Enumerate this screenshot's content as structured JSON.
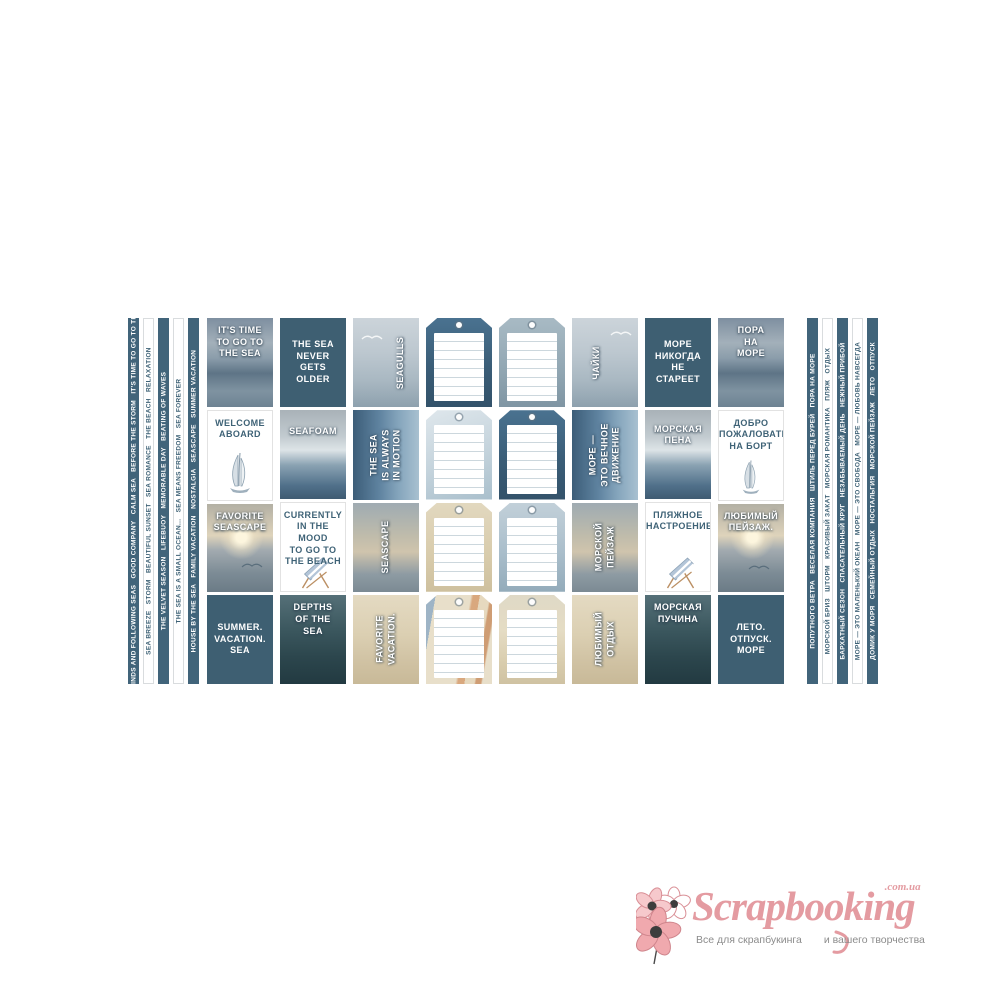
{
  "page": {
    "background": "#ffffff"
  },
  "colors": {
    "teal_solid": "#3e5f72",
    "strip_dark": "#41647a",
    "strip_light_text": "#3e6276",
    "card_text_on_photo": "#ffffff",
    "logo_pink": "#e49ba1",
    "tagline_gray": "#8c8c8c"
  },
  "strips_left": [
    {
      "variant": "dark",
      "text": "FAIR WINDS AND FOLLOWING SEAS   GOOD COMPANY   CALM SEA   BEFORE THE STORM   IT'S TIME TO GO TO THE SEA"
    },
    {
      "variant": "light",
      "text": "SEA BREEZE   STORM   BEAUTIFUL SUNSET   SEA ROMANCE   THE BEACH   RELAXATION"
    },
    {
      "variant": "dark",
      "text": "THE VELVET SEASON   LIFEBUOY   MEMORABLE DAY   BEATING OF WAVES"
    },
    {
      "variant": "light",
      "text": "THE SEA IS A SMALL OCEAN...   SEA MEANS FREEDOM   SEA FOREVER"
    },
    {
      "variant": "dark",
      "text": "HOUSE BY THE SEA   FAMILY VACATION   NOSTALGIA   SEASCAPE   SUMMER VACATION"
    }
  ],
  "strips_right": [
    {
      "variant": "dark",
      "text": "ПОПУТНОГО ВЕТРА   ВЕСЕЛАЯ КОМПАНИЯ   ШТИЛЬ ПЕРЕД БУРЕЙ   ПОРА НА МОРЕ"
    },
    {
      "variant": "light",
      "text": "МОРСКОЙ БРИЗ   ШТОРМ   КРАСИВЫЙ ЗАКАТ   МОРСКАЯ РОМАНТИКА   ПЛЯЖ   ОТДЫХ"
    },
    {
      "variant": "dark",
      "text": "БАРХАТНЫЙ СЕЗОН   СПАСАТЕЛЬНЫЙ КРУГ   НЕЗАБЫВАЕМЫЙ ДЕНЬ   НЕЖНЫЙ ПРИБОЙ"
    },
    {
      "variant": "light",
      "text": "МОРЕ — ЭТО МАЛЕНЬКИЙ ОКЕАН   МОРЕ — ЭТО СВОБОДА   МОРЕ — ЛЮБОВЬ НАВСЕГДА"
    },
    {
      "variant": "dark",
      "text": "ДОМИК У МОРЯ   СЕМЕЙНЫЙ ОТДЫХ   НОСТАЛЬГИЯ   МОРСКОЙ ПЕЙЗАЖ   ЛЕТО   ОТПУСК"
    }
  ],
  "cards": {
    "c1r1": "IT'S TIME\nTO GO TO\nTHE SEA",
    "c1r2": "WELCOME\nABOARD",
    "c1r3": "FAVORITE\nSEASCAPE",
    "c1r4": "SUMMER.\nVACATION.\nSEA",
    "c2r1": "THE SEA\nNEVER\nGETS\nOLDER",
    "c2r2": "SEAFOAM",
    "c2r3": "CURRENTLY\nIN THE MOOD\nTO GO TO\nTHE BEACH",
    "c2r4": "DEPTHS\nOF THE\nSEA",
    "c3r1": "SEAGULLS",
    "c3r2": "THE SEA\nIS ALWAYS\nIN MOTION",
    "c3r3": "SEASCAPE",
    "c3r4": "FAVORITE\nVACATION.",
    "c6r1": "ЧАЙКИ",
    "c6r2": "МОРЕ —\nЭТО ВЕЧНОЕ\nДВИЖЕНИЕ",
    "c6r3": "МОРСКОЙ\nПЕЙЗАЖ",
    "c6r4": "ЛЮБИМЫЙ\nОТДЫХ",
    "c7r1": "МОРЕ\nНИКОГДА\nНЕ\nСТАРЕЕТ",
    "c7r2": "МОРСКАЯ\nПЕНА",
    "c7r3": "ПЛЯЖНОЕ\nНАСТРОЕНИЕ.",
    "c7r4": "МОРСКАЯ\nПУЧИНА",
    "c8r1": "ПОРА\nНА\nМОРЕ",
    "c8r2": "ДОБРО\nПОЖАЛОВАТЬ\nНА БОРТ",
    "c8r3": "ЛЮБИМЫЙ\nПЕЙЗАЖ.",
    "c8r4": "ЛЕТО.\nОТПУСК.\nМОРЕ"
  },
  "tags": {
    "column_1": [
      "deep-sea-photo",
      "pale-blue-photo",
      "sand-photo",
      "jellyfish-photo"
    ],
    "column_2": [
      "gray-blue-photo",
      "deep-sea-photo",
      "mist-blue-photo",
      "sand-shells-photo"
    ],
    "note": "blank journaling tags with punched hole and ruled writing panel"
  },
  "icons": {
    "sailboat-icon": "hand-drawn sailboat sketch",
    "beach-chair-icon": "blue striped deck chair sketch",
    "seagull-icon": "flying seagull",
    "flower-logo-icon": "pink anemone flowers"
  },
  "logo": {
    "brand": "Scrapbooking",
    "domain": ".com.ua",
    "tagline_left": "Все для скрапбукинга",
    "tagline_right": "и вашего творчества"
  }
}
